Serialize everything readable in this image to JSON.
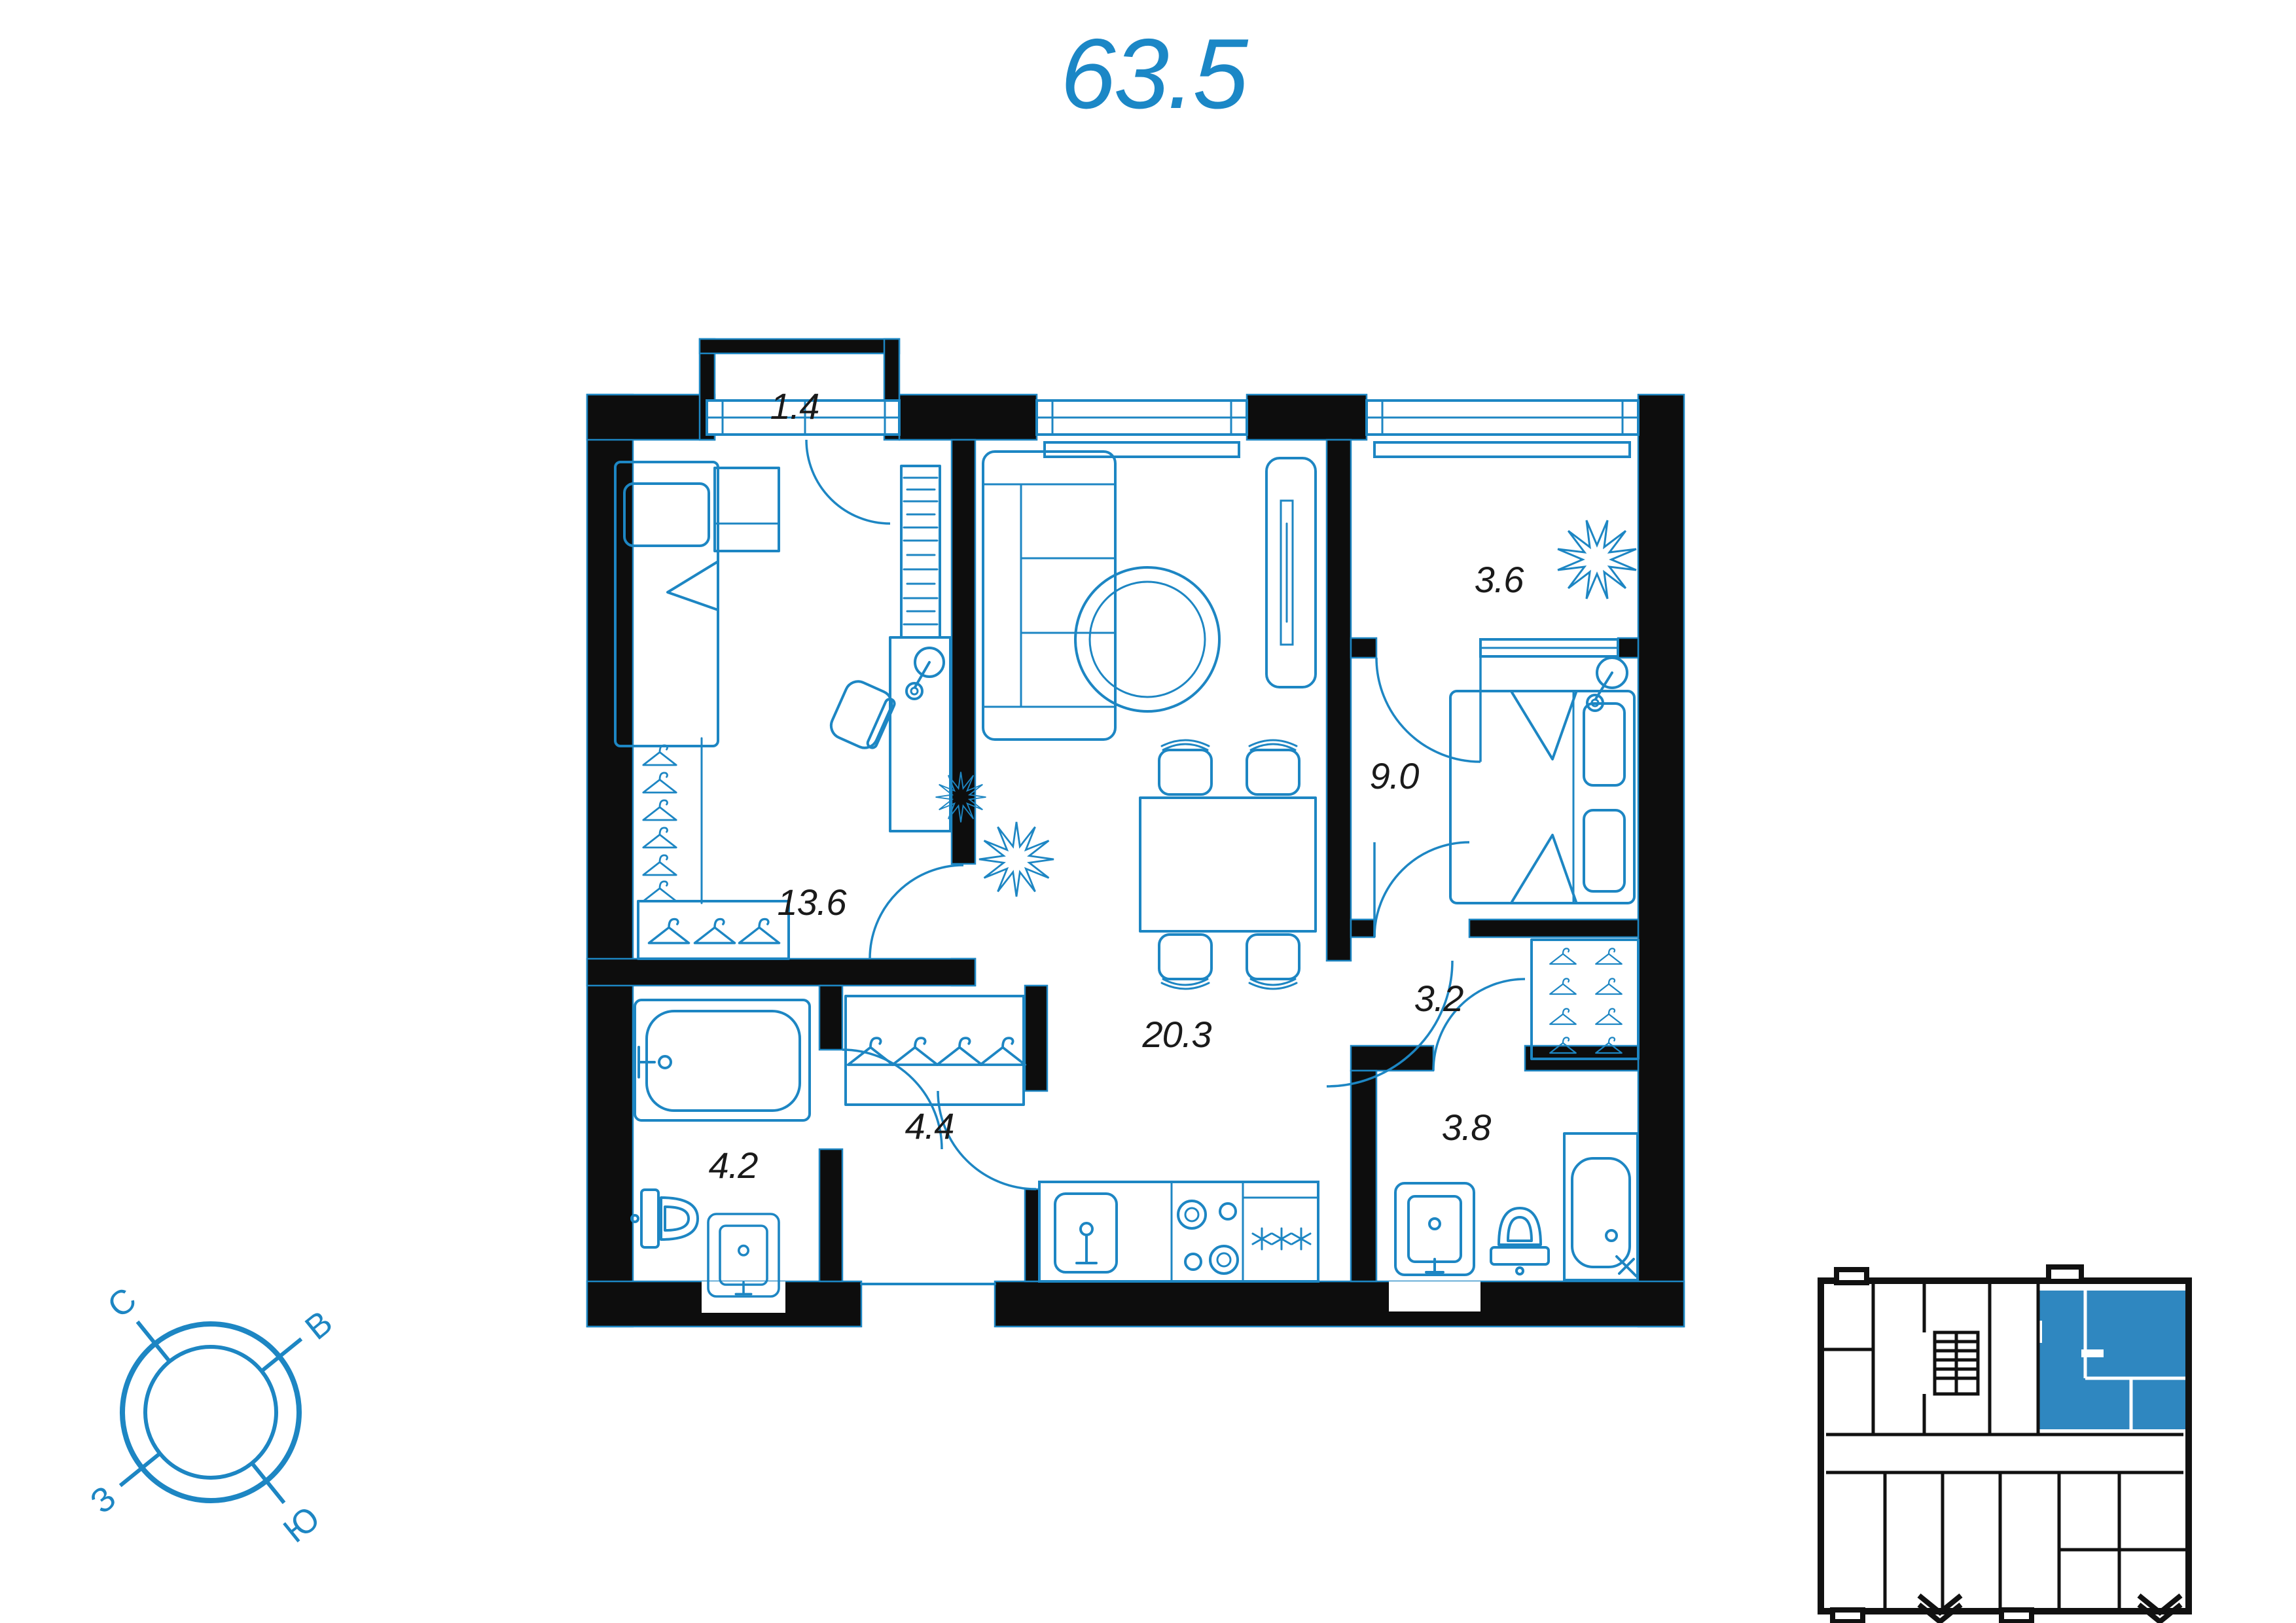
{
  "title": "63.5",
  "colors": {
    "accent": "#1d86c3",
    "walls": "#0d0d0d",
    "minimap_highlight": "#2f87c0"
  },
  "rooms": [
    {
      "name": "balcony-small",
      "label": "1.4"
    },
    {
      "name": "bedroom-main",
      "label": "13.6"
    },
    {
      "name": "loggia",
      "label": "3.6"
    },
    {
      "name": "bedroom-second",
      "label": "9.0"
    },
    {
      "name": "living-kitchen",
      "label": "20.3"
    },
    {
      "name": "hall",
      "label": "3.2"
    },
    {
      "name": "bathroom",
      "label": "4.2"
    },
    {
      "name": "entrance-hallway",
      "label": "4.4"
    },
    {
      "name": "shower-room",
      "label": "3.8"
    }
  ],
  "compass": {
    "north": "С",
    "east": "В",
    "south": "Ю",
    "west": "З"
  }
}
